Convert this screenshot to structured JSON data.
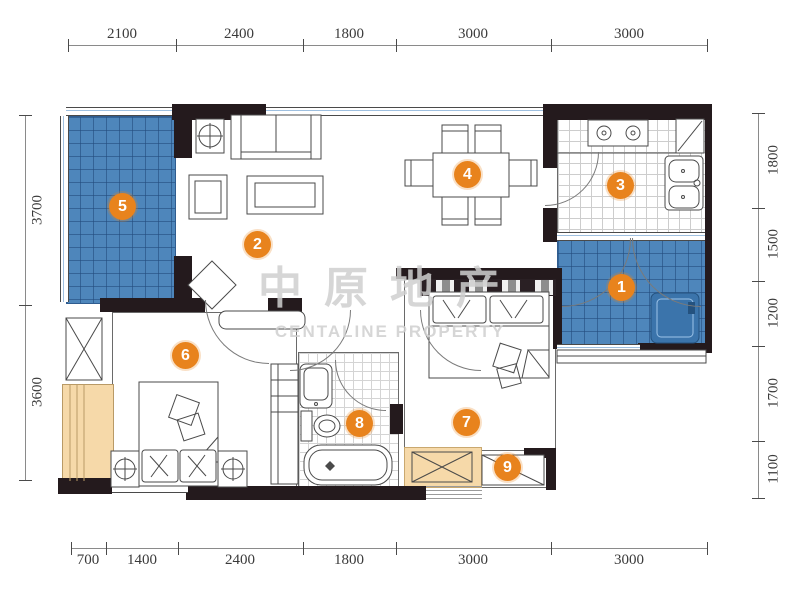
{
  "watermark": {
    "cn": "中原地产",
    "en": "CENTALINE PROPERTY"
  },
  "rooms": [
    "1",
    "2",
    "3",
    "4",
    "5",
    "6",
    "7",
    "8",
    "9"
  ],
  "dimensions": {
    "top": [
      "2100",
      "2400",
      "1800",
      "3000",
      "3000"
    ],
    "bottom": [
      "700",
      "1400",
      "2400",
      "1800",
      "3000",
      "3000"
    ],
    "left": [
      "3700",
      "3600"
    ],
    "right": [
      "1800",
      "1500",
      "1200",
      "1700",
      "1100"
    ]
  },
  "colors": {
    "marker": "#E8831D",
    "balcony_tile": "#4E86BB",
    "bay_window": "#F6D9A9",
    "wall": "#241A1D"
  }
}
